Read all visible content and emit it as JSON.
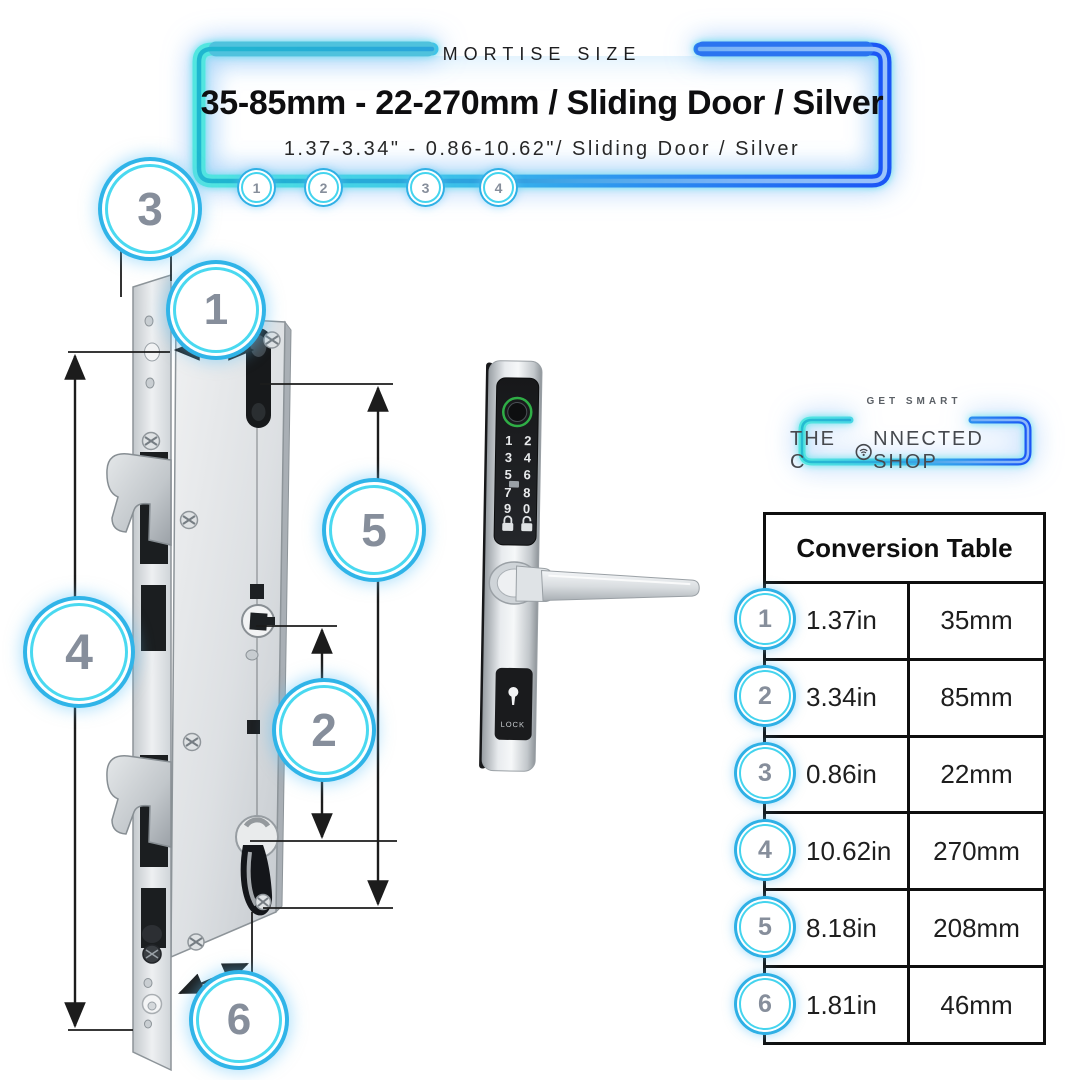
{
  "header": {
    "eyebrow": "MORTISE SIZE",
    "title": "35-85mm - 22-270mm / Sliding Door / Silver",
    "subtitle": "1.37-3.34\" - 0.86-10.62\"/ Sliding Door / Silver",
    "step_badges": [
      "1",
      "2",
      "3",
      "4"
    ]
  },
  "diagram": {
    "callouts": [
      {
        "label": "3"
      },
      {
        "label": "1"
      },
      {
        "label": "5"
      },
      {
        "label": "4"
      },
      {
        "label": "2"
      },
      {
        "label": "6"
      }
    ]
  },
  "product": {
    "keypad_digits": [
      "1",
      "2",
      "3",
      "4",
      "5",
      "6",
      "7",
      "8",
      "9",
      "0"
    ],
    "lock_label": "LOCK"
  },
  "logo": {
    "tagline": "GET SMART",
    "name_before": "THE C",
    "name_after": "NNECTED SHOP"
  },
  "conversion_table": {
    "title": "Conversion Table",
    "rows": [
      {
        "num": "1",
        "inches": "1.37in",
        "mm": "35mm"
      },
      {
        "num": "2",
        "inches": "3.34in",
        "mm": "85mm"
      },
      {
        "num": "3",
        "inches": "0.86in",
        "mm": "22mm"
      },
      {
        "num": "4",
        "inches": "10.62in",
        "mm": "270mm"
      },
      {
        "num": "5",
        "inches": "8.18in",
        "mm": "208mm"
      },
      {
        "num": "6",
        "inches": "1.81in",
        "mm": "46mm"
      }
    ]
  },
  "colors": {
    "frame_cyan": "#4ae0e2",
    "frame_blue": "#1b55f5",
    "ring_cyan": "#30b4e8",
    "callout_text": "#868e9b",
    "fingerprint_green": "#2fae46"
  }
}
